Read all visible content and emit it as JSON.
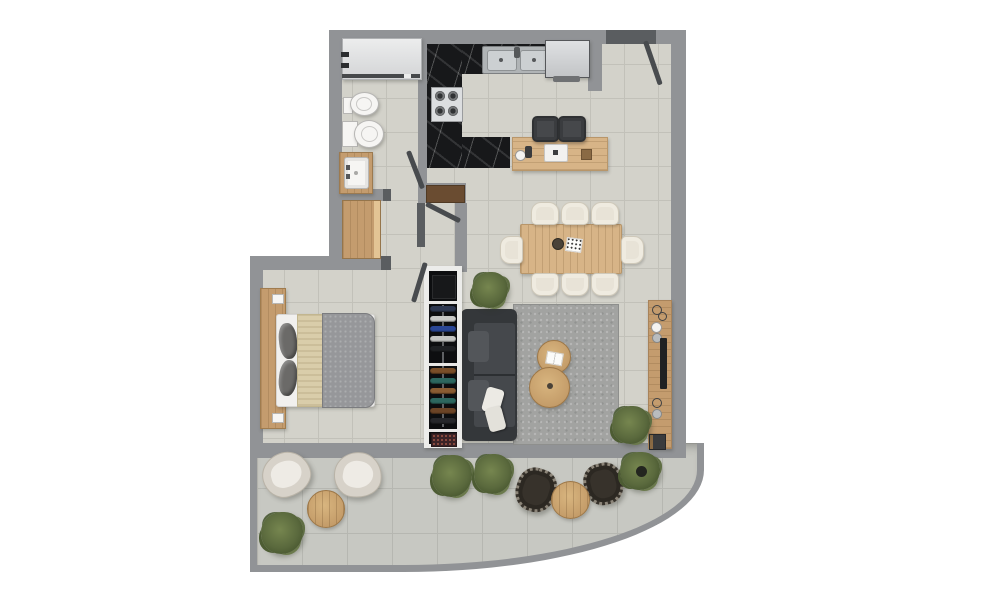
{
  "scene": {
    "kind": "apartment floor plan, top-down 3D render, no text labels",
    "rooms": [
      {
        "name": "bathroom",
        "furniture": [
          "shower",
          "bidet",
          "toilet",
          "wood vanity with sink"
        ]
      },
      {
        "name": "kitchen",
        "furniture": [
          "L-shaped black marble counter",
          "stainless double sink",
          "4-burner cooktop",
          "refrigerator",
          "wood breakfast island",
          "bar stool",
          "bar stool",
          "coffee set",
          "laptop",
          "small planter box"
        ]
      },
      {
        "name": "hallway",
        "furniture": [
          "wood storage cabinet",
          "built-in dark wood cabinet"
        ]
      },
      {
        "name": "dining area",
        "furniture": [
          "wood dining table",
          "upholstered chair x8",
          "dark bowl centerpiece",
          "white card"
        ]
      },
      {
        "name": "living area",
        "furniture": [
          "charcoal sofa",
          "white throw pillow x2",
          "gray area rug",
          "round wood coffee table x2",
          "open book",
          "wood media console",
          "tv soundbar",
          "potted plant x2",
          "decor rings",
          "vases"
        ]
      },
      {
        "name": "bedroom",
        "furniture": [
          "double bed",
          "wood headboard panel",
          "gray duvet",
          "beige runner blanket",
          "dark pillow x2",
          "open wardrobe with hanging clothes"
        ]
      },
      {
        "name": "balcony",
        "furniture": [
          "cream lounge chair x2",
          "round wood side table x2",
          "dark rattan chair x2",
          "potted plant x4"
        ]
      }
    ],
    "doors": [
      "entry door top-right",
      "bathroom door",
      "bedroom door",
      "kitchen passage door"
    ],
    "wardrobe": {
      "upper_rack": [
        "#2e3850",
        "#c8c9c7",
        "#2b4796",
        "#c3c4c2",
        "#1e2023"
      ],
      "lower_rack": [
        "#7a4e28",
        "#2d675f",
        "#8a5c32",
        "#2d675f",
        "#6b4426",
        "#26272b"
      ]
    }
  },
  "palette": {
    "wall": "#919396",
    "wall-dark": "#5a5d60",
    "door": "#484b4e",
    "floor": "#d3d2ca",
    "grout": "#c2c1b9",
    "balcony-floor": "#c7c8c2",
    "balcony-grout": "#b6b7b1",
    "marble": "#17181a",
    "wood-light": "#d7b487",
    "wood-mid": "#c49c6e",
    "wood-deep": "#6a4c31",
    "steel": "#b9bcbe",
    "fixture": "#f6f5f3",
    "sofa": "#34373a",
    "sofa-seat": "#45484c",
    "sofa-cushion": "#53565a",
    "rug": "#a2a3a1",
    "cream": "#e8e3d7",
    "stool": "#46484b",
    "closet-frame": "#ececea",
    "closet-bg": "#0d0e10",
    "duvet": "#96979a",
    "blanket": "#d9cdaa",
    "pillow-dark": "#6b6a68",
    "outdoor-chair": "#37322b"
  }
}
